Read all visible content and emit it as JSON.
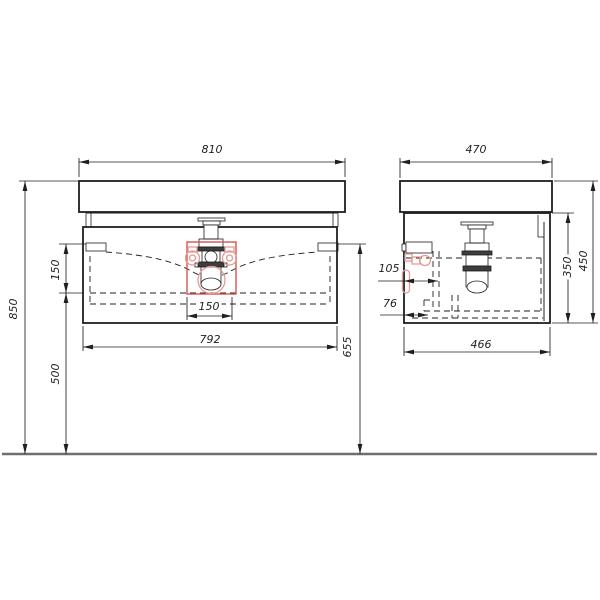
{
  "drawing": {
    "subject": "Wall-hung bathroom vanity unit with washbasin and bottle-trap siphon, front and side orthographic views",
    "units": "mm",
    "colors": {
      "line": "#1f1f1f",
      "red": "#d9534f",
      "red_light": "#e59a94",
      "floor": "#6f6f6f"
    },
    "front_view": {
      "dims": {
        "top_width": "810",
        "body_width": "792",
        "cutout_width": "150",
        "bracket_to_drawer": "150",
        "overall_height": "850",
        "drawer_to_floor": "500",
        "bracket_to_floor": "655"
      }
    },
    "side_view": {
      "dims": {
        "top_depth": "470",
        "body_depth": "466",
        "body_height": "350",
        "overall_height": "450",
        "supply_offset": "105",
        "drain_offset": "76"
      }
    }
  }
}
